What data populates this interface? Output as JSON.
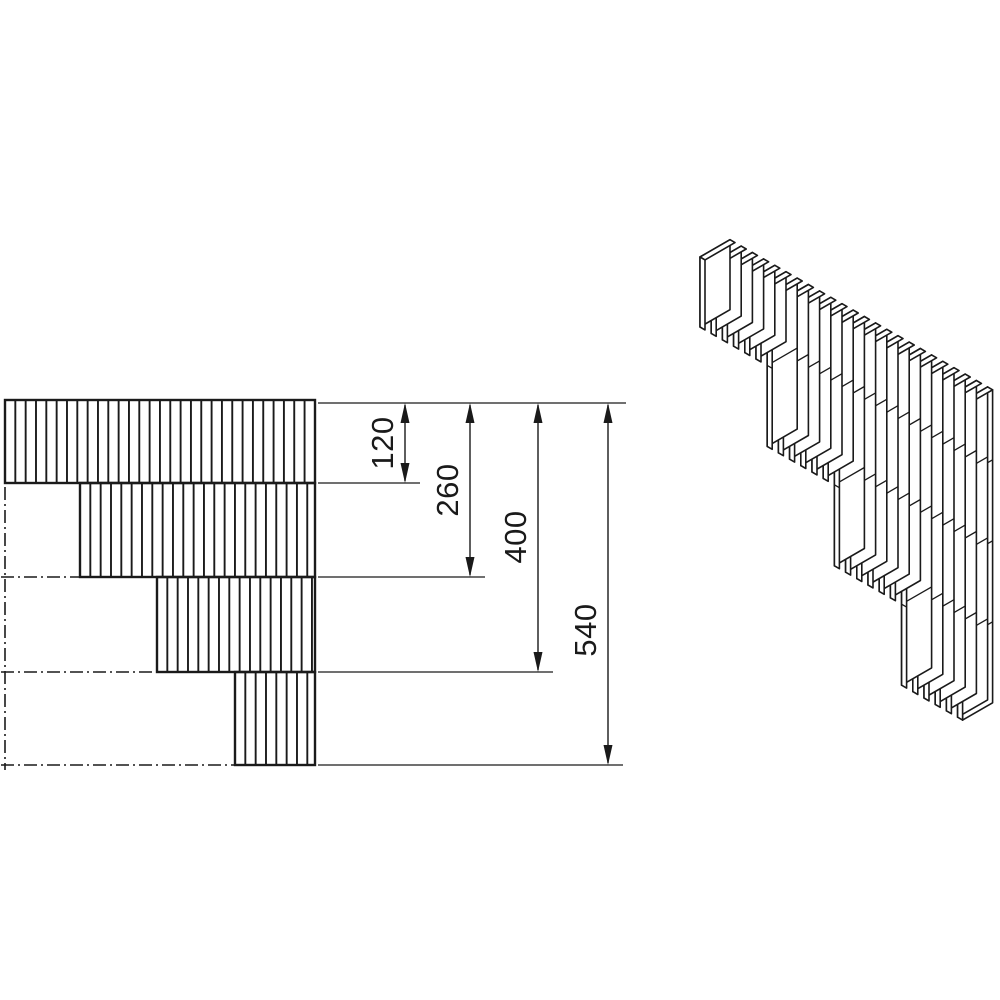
{
  "figure": {
    "description": "Technical drawing of a stepped slat block corner element: front elevation with hatched courses and dimension chain, plus isometric view of vertical slats",
    "line_color": "#1a1a1a",
    "background": "#ffffff"
  },
  "diagram_data": {
    "type": "technical-drawing",
    "dimension_values": [
      120,
      260,
      400,
      540
    ],
    "views": [
      "front-elevation",
      "isometric"
    ]
  },
  "front_view": {
    "hatch_spacing": 10.33,
    "outline_width": 2.4,
    "hatch_width": 1.9,
    "rows": [
      {
        "x": 5,
        "y": 400,
        "w": 310,
        "h": 83
      },
      {
        "x": 80,
        "y": 483,
        "w": 235,
        "h": 94
      },
      {
        "x": 157,
        "y": 577,
        "w": 158,
        "h": 95
      },
      {
        "x": 235,
        "y": 672,
        "w": 80,
        "h": 93
      }
    ],
    "centerline_vertical": {
      "x": 5,
      "y1": 487,
      "y2": 770
    },
    "centerlines_horizontal": [
      {
        "y": 577,
        "x1": 1,
        "x2": 79
      },
      {
        "y": 672,
        "x1": 1,
        "x2": 156
      },
      {
        "y": 765,
        "x1": 1,
        "x2": 234
      }
    ],
    "centerline_dash": "13 4 2 4"
  },
  "dimensions": {
    "top_extension": {
      "y": 403,
      "x1": 318,
      "x2": 626
    },
    "ext_stroke": 1.3,
    "dim_stroke": 1.4,
    "arrow_len": 20,
    "arrow_half_w": 4.5,
    "items": [
      {
        "label": "120",
        "line_x": 405,
        "y_top": 403,
        "y_bot": 483,
        "ext": {
          "y": 483,
          "x1": 318,
          "x2": 420
        },
        "label_x": 393,
        "label_y": 443
      },
      {
        "label": "260",
        "line_x": 470,
        "y_top": 403,
        "y_bot": 577,
        "ext": {
          "y": 577,
          "x1": 318,
          "x2": 485
        },
        "label_x": 458,
        "label_y": 490
      },
      {
        "label": "400",
        "line_x": 538,
        "y_top": 403,
        "y_bot": 672,
        "ext": {
          "y": 672,
          "x1": 318,
          "x2": 553
        },
        "label_x": 526,
        "label_y": 537
      },
      {
        "label": "540",
        "line_x": 608,
        "y_top": 403,
        "y_bot": 765,
        "ext": {
          "y": 765,
          "x1": 318,
          "x2": 623
        },
        "label_x": 596,
        "label_y": 630
      }
    ]
  },
  "iso_view": {
    "origin": [
      700,
      257
    ],
    "pitch": [
      11.2,
      6.4
    ],
    "thickness": [
      5,
      2.9
    ],
    "depth": [
      30,
      -17.3
    ],
    "group_counts": [
      6,
      6,
      6,
      6
    ],
    "group_heights": [
      70,
      151,
      232,
      313
    ],
    "joint_levels": [
      70,
      151,
      232
    ],
    "stroke_width": 1.6,
    "joint_stroke": 1.3
  }
}
